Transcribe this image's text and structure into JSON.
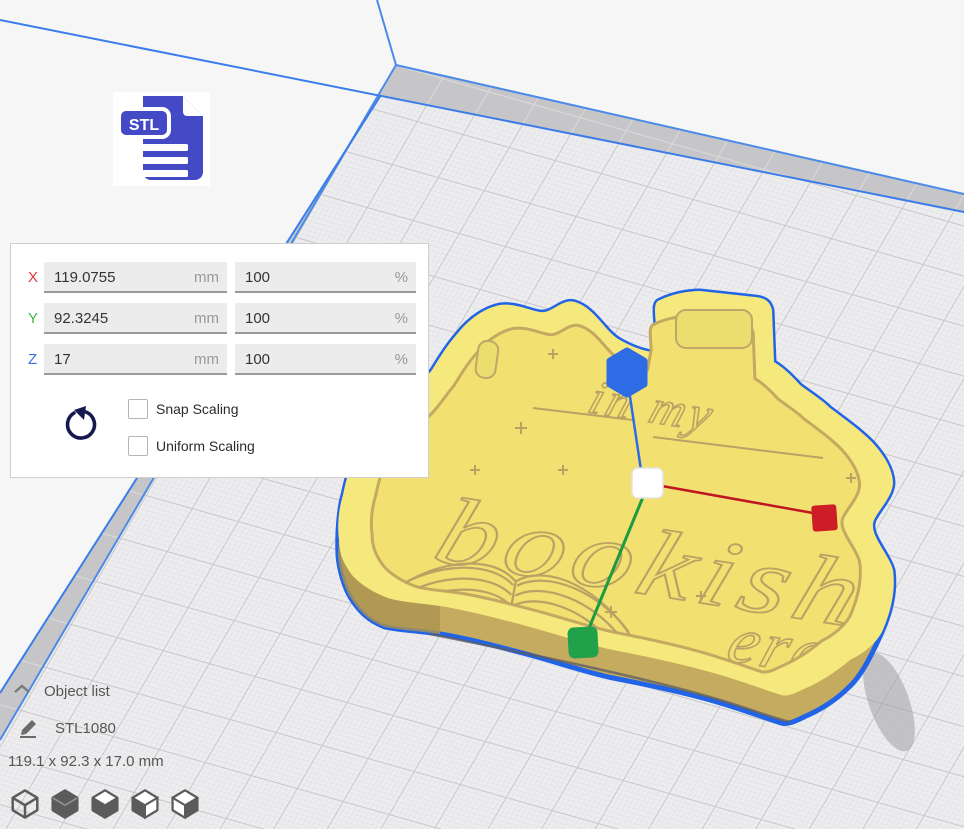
{
  "scale_panel": {
    "rows": [
      {
        "axis": "X",
        "axis_color": "#e23a3a",
        "value": "119.0755",
        "unit": "mm",
        "percent": "100",
        "percent_unit": "%"
      },
      {
        "axis": "Y",
        "axis_color": "#3cb83c",
        "value": "92.3245",
        "unit": "mm",
        "percent": "100",
        "percent_unit": "%"
      },
      {
        "axis": "Z",
        "axis_color": "#3a6fe0",
        "value": "17",
        "unit": "mm",
        "percent": "100",
        "percent_unit": "%"
      }
    ],
    "checkboxes": [
      {
        "label": "Snap Scaling",
        "checked": false
      },
      {
        "label": "Uniform Scaling",
        "checked": false
      }
    ]
  },
  "file_icon": {
    "label": "STL",
    "color": "#4449c6"
  },
  "object_panel": {
    "header": "Object list",
    "item": "STL1080",
    "dimensions": "119.1 x 92.3 x 17.0 mm"
  },
  "view_toolbar": {
    "icons": [
      "3d-view",
      "front-view",
      "top-view",
      "left-side-view",
      "right-side-view"
    ]
  },
  "model": {
    "engraving_lines": [
      "in my",
      "bookish",
      "era"
    ],
    "body_color": "#f5e87d",
    "wall_color": "#c5ab60",
    "selection_outline_color": "#2264e8"
  },
  "handles": {
    "x_color": "#cf1d27",
    "y_color": "#22a14b",
    "z_color": "#2d6ce5",
    "center_color": "#ffffff"
  },
  "build_plate": {
    "line_color": "#3b7de8"
  }
}
